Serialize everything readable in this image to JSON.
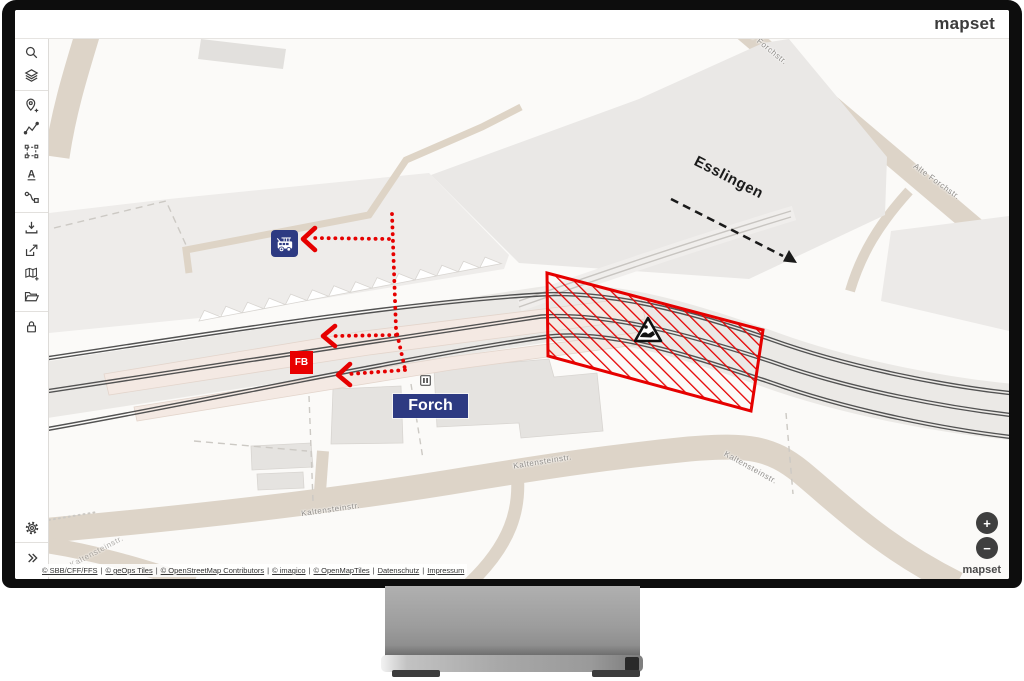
{
  "brand": {
    "logo": "mapset",
    "logo_bottom": "mapset"
  },
  "sidebar": {
    "tools": [
      {
        "icon": "search-icon"
      },
      {
        "icon": "layers-icon"
      },
      {
        "icon": "add-location-icon"
      },
      {
        "icon": "draw-line-icon"
      },
      {
        "icon": "select-area-icon"
      },
      {
        "icon": "text-tool-icon"
      },
      {
        "icon": "route-connection-icon"
      },
      {
        "icon": "download-icon"
      },
      {
        "icon": "share-icon"
      },
      {
        "icon": "add-map-icon"
      },
      {
        "icon": "folder-icon"
      },
      {
        "icon": "lock-icon"
      },
      {
        "icon": "settings-icon"
      },
      {
        "icon": "expand-icon"
      }
    ],
    "text_tool_letter": "A",
    "expand_glyph": "»"
  },
  "map": {
    "station_label": "Forch",
    "stop_code": "FB",
    "direction_label": "Esslingen",
    "street_labels": [
      "Alte Forchstr.",
      "Alte Forchstr.",
      "Kaltensteinstr.",
      "Kaltensteinstr.",
      "Kaltensteinstr.",
      "Kaltensteinstr."
    ],
    "colors": {
      "accent_red": "#e60000",
      "navy": "#2d3a82",
      "road": "#ddd4c8",
      "platform": "#f4e9e3"
    }
  },
  "controls": {
    "zoom_in": "+",
    "zoom_out": "−"
  },
  "attribution": {
    "links": [
      "© SBB/CFF/FFS",
      "© geOps Tiles",
      "© OpenStreetMap Contributors",
      "© imagico",
      "© OpenMapTiles",
      "Datenschutz",
      "Impressum"
    ],
    "separator": "|"
  }
}
